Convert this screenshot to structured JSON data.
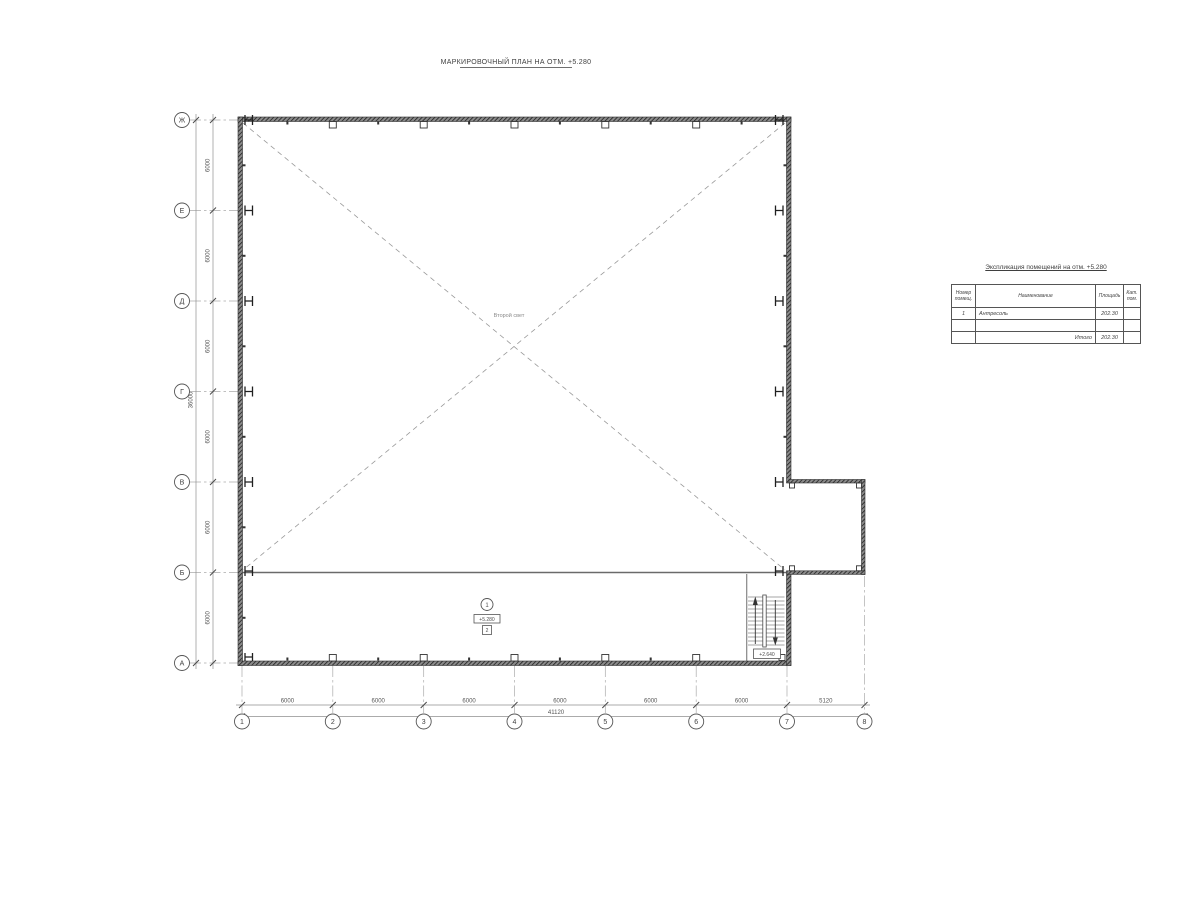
{
  "sheet_title": "МАРКИРОВОЧНЫЙ ПЛАН НА ОТМ. +5.280",
  "axes": {
    "rows": [
      "Ж",
      "Е",
      "Д",
      "Г",
      "В",
      "Б",
      "А"
    ],
    "cols": [
      "1",
      "2",
      "3",
      "4",
      "5",
      "6",
      "7",
      "8"
    ]
  },
  "dimensions": {
    "left_segments": [
      "6000",
      "6000",
      "6000",
      "6000",
      "6000",
      "6000"
    ],
    "left_total": "36000",
    "bottom_segments": [
      "6000",
      "6000",
      "6000",
      "6000",
      "6000",
      "6000",
      "5120"
    ],
    "bottom_total": "41120"
  },
  "plan": {
    "void_label": "Второй свет",
    "room_number": "1",
    "room_elevation": "+5.280",
    "floor_finish_tag": "2",
    "stair_landing_elevation": "+2.640"
  },
  "table": {
    "title": "Экспликация помещений на отм. +5.280",
    "headers": [
      "Номер помещ.",
      "Наименование",
      "Площадь",
      "Кат. пом."
    ],
    "rows": [
      {
        "num": "1",
        "name": "Антресоль",
        "area": "202.30",
        "cat": ""
      },
      {
        "num": "",
        "name": "",
        "area": "",
        "cat": ""
      }
    ],
    "total_label": "Итого",
    "total_area": "202.30"
  },
  "colors": {
    "wall": "#2f2f2f",
    "line": "#4d4d4d",
    "dash": "#9a9a9a",
    "background": "#ffffff"
  }
}
